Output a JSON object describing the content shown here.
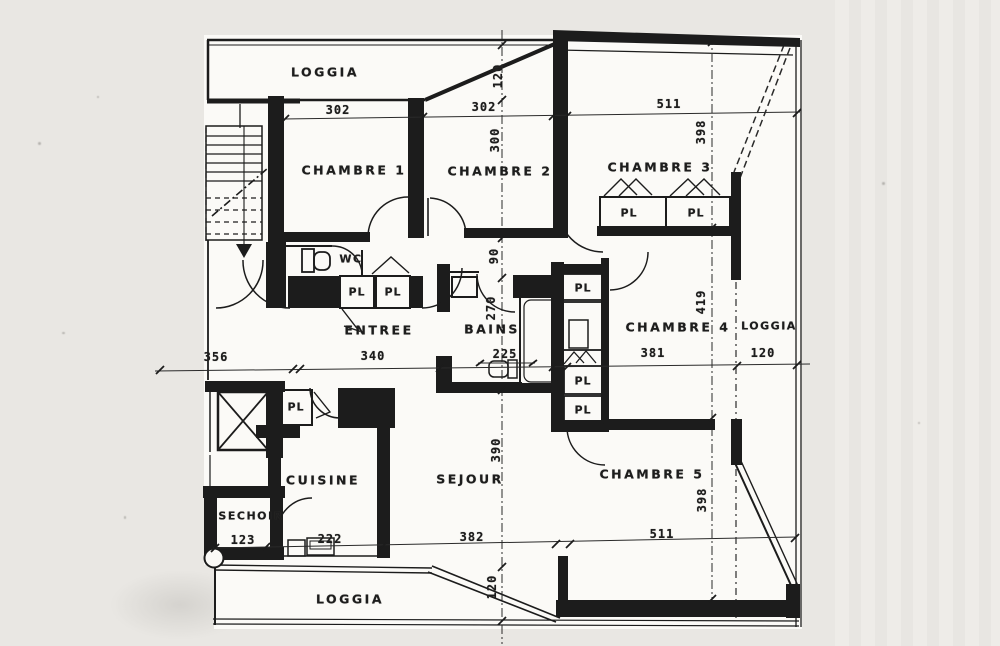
{
  "document": {
    "kind": "Scanned architectural floor plan (apartment)",
    "language": "French",
    "units": "centimeters (implied by dimension chains)"
  },
  "colors": {
    "ink": "#1c1c1c",
    "scan_background": "#e9e7e3",
    "paper": "#fbfaf7"
  },
  "rooms": [
    {
      "id": "loggia-top",
      "label": "LOGGIA"
    },
    {
      "id": "chambre-1",
      "label": "CHAMBRE 1"
    },
    {
      "id": "chambre-2",
      "label": "CHAMBRE 2"
    },
    {
      "id": "chambre-3",
      "label": "CHAMBRE 3"
    },
    {
      "id": "wc",
      "label": "WC"
    },
    {
      "id": "entree",
      "label": "ENTREE"
    },
    {
      "id": "bains",
      "label": "BAINS"
    },
    {
      "id": "chambre-4",
      "label": "CHAMBRE 4"
    },
    {
      "id": "loggia-right",
      "label": "LOGGIA"
    },
    {
      "id": "cuisine",
      "label": "CUISINE"
    },
    {
      "id": "sechoir",
      "label": "SECHOIR"
    },
    {
      "id": "sejour",
      "label": "SEJOUR"
    },
    {
      "id": "chambre-5",
      "label": "CHAMBRE 5"
    },
    {
      "id": "loggia-bottom",
      "label": "LOGGIA"
    }
  ],
  "closets": [
    {
      "label": "PL",
      "location": "chambre-3-left"
    },
    {
      "label": "PL",
      "location": "chambre-3-right"
    },
    {
      "label": "PL",
      "location": "hall-left"
    },
    {
      "label": "PL",
      "location": "hall-right"
    },
    {
      "label": "PL",
      "location": "stack-top-near-bains"
    },
    {
      "label": "PL",
      "location": "stack-middle"
    },
    {
      "label": "PL",
      "location": "stack-bottom"
    },
    {
      "label": "PL",
      "location": "near-elevator"
    }
  ],
  "dimensions": {
    "horizontal": [
      {
        "value": "302",
        "segment": "chambre-1 width (top)"
      },
      {
        "value": "302",
        "segment": "chambre-2 width (top)"
      },
      {
        "value": "511",
        "segment": "chambre-3 width (top)"
      },
      {
        "value": "356",
        "segment": "left exterior (mid)"
      },
      {
        "value": "340",
        "segment": "entree width (mid)"
      },
      {
        "value": "225",
        "segment": "bains width (mid)"
      },
      {
        "value": "381",
        "segment": "chambre-4 width (mid)"
      },
      {
        "value": "120",
        "segment": "loggia-right depth (mid)"
      },
      {
        "value": "123",
        "segment": "sechoir width (bottom)"
      },
      {
        "value": "222",
        "segment": "cuisine width (bottom)"
      },
      {
        "value": "382",
        "segment": "sejour width (bottom)"
      },
      {
        "value": "511",
        "segment": "chambre-5 width (bottom)"
      }
    ],
    "vertical": [
      {
        "value": "120",
        "segment": "loggia-top depth"
      },
      {
        "value": "300",
        "segment": "chambre-2 depth"
      },
      {
        "value": "90",
        "segment": "hall width"
      },
      {
        "value": "270",
        "segment": "bains depth"
      },
      {
        "value": "390",
        "segment": "sejour depth"
      },
      {
        "value": "120",
        "segment": "loggia-bottom depth"
      },
      {
        "value": "398",
        "segment": "chambre-3 depth (right chain)"
      },
      {
        "value": "419",
        "segment": "chambre-4 depth (right chain)"
      },
      {
        "value": "398",
        "segment": "chambre-5 depth (right chain)"
      }
    ]
  }
}
